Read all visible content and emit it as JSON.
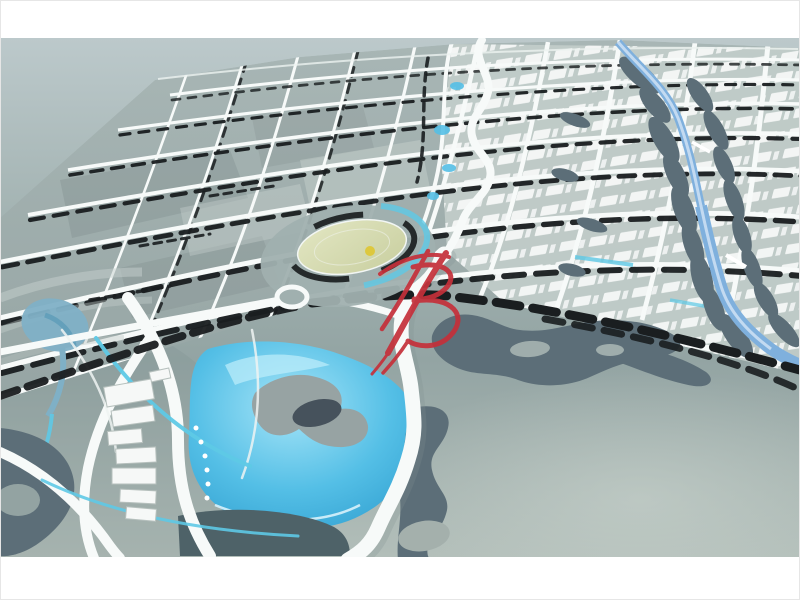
{
  "meta": {
    "alt": "Photograph of an architectural scale model of a city master plan seen from an angle: a perspective street grid with dark tree rows, a lighter district of white buildings, a winding white boulevard, a blue river with dark organic banks, a large cyan lake with a gray island, a round yellow-green plaza, and a red calligraphic watermark logo in the center."
  },
  "watermark": {
    "style": "red calligraphic brush logo",
    "color": "#c5303a"
  },
  "palette": {
    "frame-white": "#ffffff",
    "backdrop-top": "#bcc9cb",
    "backdrop-mid": "#a3b3b2",
    "backdrop-low": "#93a4a3",
    "backdrop-bottom": "#b2beb9",
    "block-gray": "#9fadac",
    "block-shade": "#7e8c8c",
    "block-light": "#c2cdca",
    "road-white": "#f7faf9",
    "tree-black": "#1a1e20",
    "slate-dark": "#5c6e78",
    "river-blue": "#7fb0dd",
    "river-light": "#cfe2f4",
    "lake-cyan": "#54bfe6",
    "lake-light": "#a5e4f7",
    "lake-deep": "#2f9ecf",
    "island-gray": "#97a3a3",
    "island-dark": "#46525c",
    "plaza-green": "#c9cfa0",
    "plaza-light": "#e2e6c2",
    "pond-blue": "#7fb0c6",
    "canal-cyan": "#5ec9e6",
    "cluster-white": "#f6f8f7",
    "dot-yellow": "#ddc83e",
    "watermark-red": "#c5303a"
  },
  "scene": {
    "elements": [
      "street-grid-district",
      "white-building-district",
      "winding-canal",
      "grand-boulevard",
      "blue-river",
      "cyan-lake",
      "lake-island",
      "central-plaza",
      "roundabout",
      "tree-rows",
      "slate-parks",
      "watermark-logo"
    ]
  }
}
